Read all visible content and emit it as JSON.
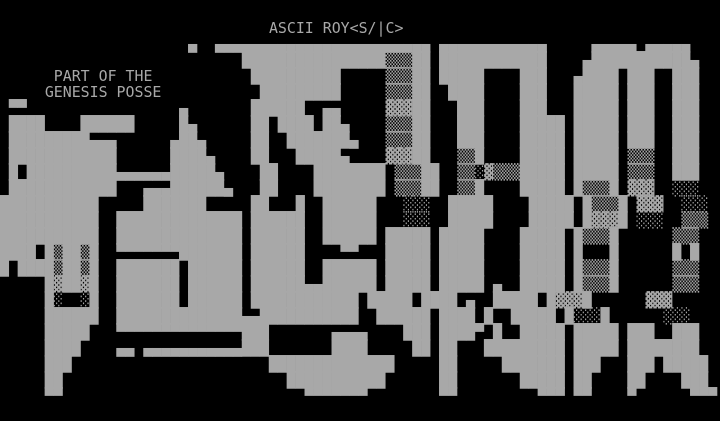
{
  "screen": {
    "background_color": "#000000",
    "foreground_color": "#a8a8a8"
  },
  "art": {
    "title_label": "ASCII ROY<S/|C>",
    "credit_line1": "PART OF THE",
    "credit_line2": "GENESIS POSSE",
    "word": "JAM",
    "rows": [
      "                                                                                ",
      "                              ASCII ROY<S/|C>                                   ",
      "                     ▄  ▄▄▄▄▄▄▄▄▄▄▄▄▄▄▄▄▄▄▄▄▄▄▄▄ ▄▄▄▄▄▄▄▄▄▄▄▄     ▄▄▄▄▄ ▄▄▄▄▄   ",
      "                           ████████████████▒▒▒██ ████████████    ▄███████████▄  ",
      "      PART OF THE           ██████████     ▒▒▒██ █████    ███   ▄████ ███  ███  ",
      "     GENESIS POSSE           █████████     ▒▒▒██  ████    ███   █████ ███  ███  ",
      " ▀▀                 ▄       ██████  ▄▄     ▓▓▓██   ███    ███   █████ ███  ███  ",
      " ████    ██████     █▄      ██ ████ ██▄    ▒▒▒██   ███    █████ █████ ███  ███  ",
      " █████████▄▄▄      ▄██▄     ██  ███████▄   ▒▒▒██   ███    █████ █████ ███  ███  ",
      " ████████████      ████▄    ██   █████▄    ▓▓▓██   ▒▒█    █████ █████ ▒▒▒  ███  ",
      " █ ██████████▄▄▄▄▄▄█████▄    ██    ████████ ▒▒▒██  ▒▒░▓▒▒▒█████ █████ ▒▒▒  ███  ",
      " ████████████   ▄▄▄██████▄   ██    ████████ ▒▒▒██  ▒▒█    █████ █▒▒▒█ ▓▓▓  ░░░  ",
      "███████████     ███████     ██   █  ██████   ░░░  █████    █████ █▒▒▒█ ▓▓▓  ░░░  ",
      "███████████  ██████████████ ██████  ██████   ░░░  █████    █████ █▓▓▓█ ░░░  ▒▒▒  ",
      "███████████  ██████████████ ██████  ██████ █████ █████    █████ █▒▒▒█      ▒▒▒  ",
      "████ █▒██▒█  ▀▀▀▀▀▀▀███████ ██████    ▀▀   █████ █████    █████ █   █      █ █  ",
      "█ ████▒██▒█  ███████ ██████ ██████  ██████ █████ █████    █████ █▒▒▒█      ▒▒▒  ",
      "     █▓██▓█  ███████ ██████ ██████▄▄██████ █████ █████ ▄  █████ █▒▒▒█      ▒▒▒  ",
      "     █░  ░█  ███████ ██████ ████████████ █████ ████ ▄  █████ █▓▓▓█      ▓▓▓  ",
      "     ██████  ██████████████▄▄███████████  ██████ ████ █  █████ █░░░█      ░░░  ",
      "     █████   ▀▀▀▀▀▀▀▀▀▀▀▀▀▀███       ▄▄▄▄    ███ ████▀ █  █████ █████ ███  ███  ",
      "     ████    ▄▄ ▄▄▄▄▄▄▄▄▄▄▄███       ████     ██ ██   █████████ █████ ████████  ",
      "     ███                      ██████████████     ██     ███████ ███   ███ █████ ",
      "     ██                         ███████████      ██       █████ ██    ██    ███ ",
      "     ▀▀                           ▀▀▀▀▀▀▀        ▀▀         ▀▀▀ ▀▀    ▀      ▀▀▀",
      "                                                                                "
    ]
  }
}
